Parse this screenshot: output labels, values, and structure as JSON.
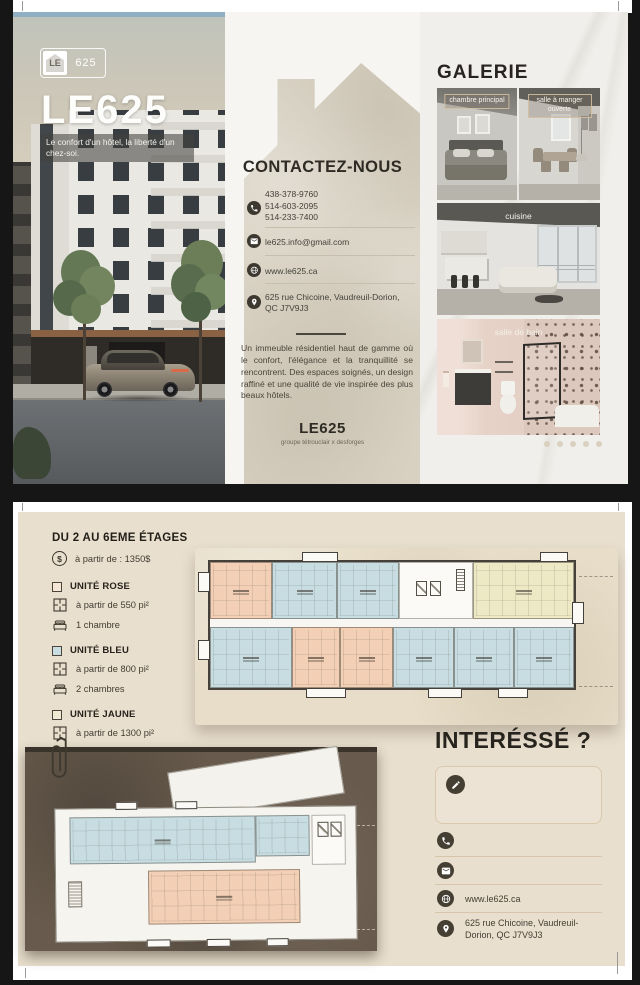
{
  "brand": {
    "logo_le": "LE",
    "logo_625": "625",
    "title": "LE625",
    "tagline": "Le confort d'un hôtel, la liberté d'un chez-soi."
  },
  "contact": {
    "heading": "CONTACTEZ-NOUS",
    "phone1": "438-378-9760",
    "phone2": "514-603-2095",
    "phone3": "514-233-7400",
    "email": "le625.info@gmail.com",
    "website": "www.le625.ca",
    "address": "625 rue Chicoine, Vaudreuil-Dorion, QC J7V9J3",
    "description": "Un immeuble résidentiel haut de gamme où le confort, l'élégance et la tranquillité se rencontrent. Des espaces soignés, un design raffiné et une qualité de vie inspirée des plus beaux hôtels.",
    "footer_brand": "LE625",
    "footer_sub": "groupe tétrouclair x desforges"
  },
  "gallery": {
    "heading": "GALERIE",
    "label_bedroom": "chambre principal",
    "label_dining": "salle à manger ouverte",
    "label_kitchen": "cuisine",
    "label_bathroom": "salle de bain"
  },
  "floors": {
    "heading": "DU 2 AU 6EME ÉTAGES",
    "price": "à partir de : 1350$",
    "units": [
      {
        "name": "UNITÉ ROSE",
        "size": "à partir de 550 pi²",
        "rooms": "1 chambre"
      },
      {
        "name": "UNITÉ BLEU",
        "size": "à partir de 800 pi²",
        "rooms": "2 chambres"
      },
      {
        "name": "UNITÉ JAUNE",
        "size": "à partir de 1300 pi²",
        "rooms": "3 chambres"
      }
    ]
  },
  "interested": {
    "heading": "INTERÉSSÉ ?",
    "website": "www.le625.ca",
    "address": "625 rue Chicoine, Vaudreuil-Dorion, QC J7V9J3"
  },
  "icons": {
    "dollar": "$"
  },
  "colors": {
    "unit_rose": "#f2cfb5",
    "unit_bleu": "#c7dde2",
    "unit_jaune": "#eee9c5",
    "swatch_rose": "#f6e6d8",
    "swatch_bleu": "#c9dee2",
    "swatch_jaune": "#f1ead3",
    "page_beige": "#e9dfce",
    "dark_text": "#2e2a24"
  }
}
